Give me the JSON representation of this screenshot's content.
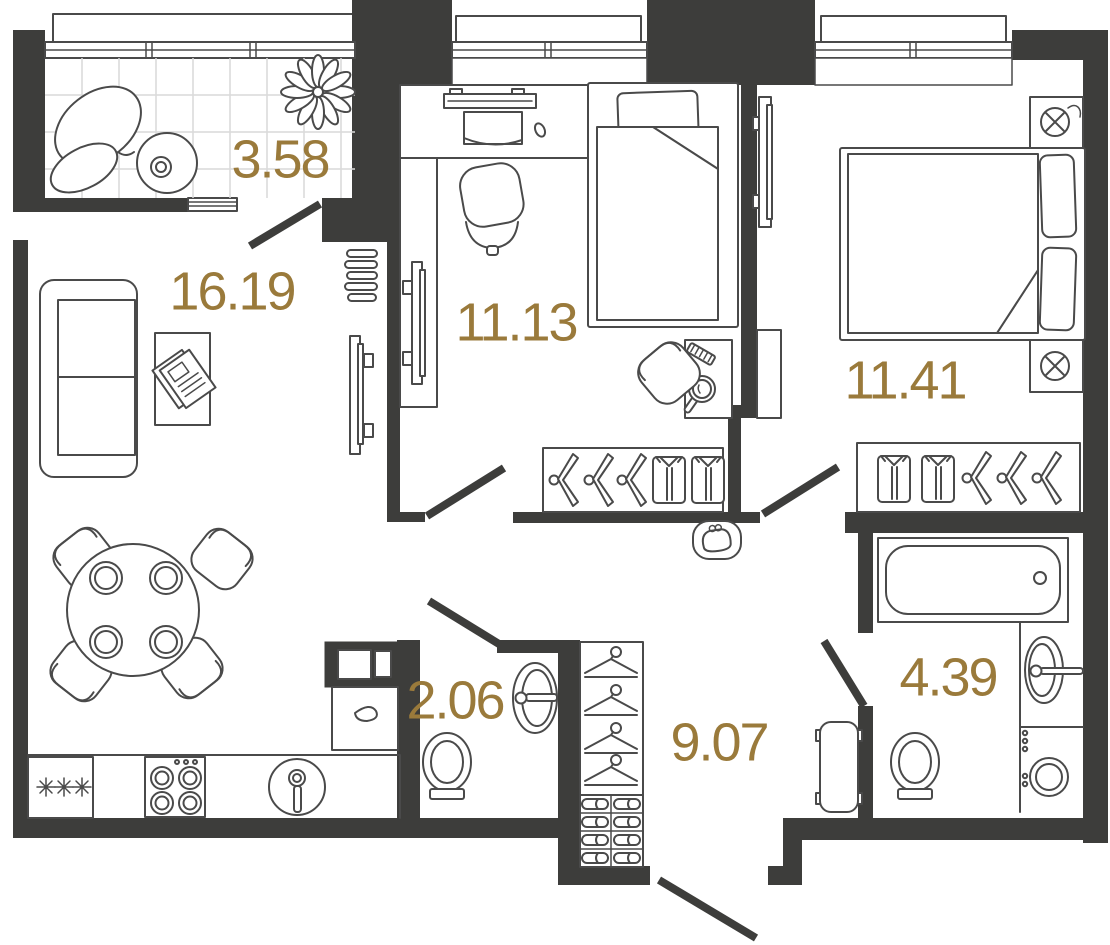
{
  "plan": {
    "type": "apartment-floor-plan",
    "rooms": [
      {
        "name": "balcony",
        "area": "3.58"
      },
      {
        "name": "living-kitchen",
        "area": "16.19"
      },
      {
        "name": "bedroom-1",
        "area": "11.13"
      },
      {
        "name": "bedroom-2",
        "area": "11.41"
      },
      {
        "name": "wc",
        "area": "2.06"
      },
      {
        "name": "hallway",
        "area": "9.07"
      },
      {
        "name": "bathroom",
        "area": "4.39"
      }
    ],
    "colors": {
      "wall": "#3d3d3b",
      "furniture_line": "#4a4a4a",
      "area_label": "#9a7a3b",
      "tile_line": "#d9d9d9",
      "background": "#ffffff"
    },
    "icons": [
      "window",
      "window-sill",
      "door-swing",
      "sofa",
      "coffee-table",
      "newspaper",
      "tv",
      "slat-shelf",
      "dining-table",
      "dining-chair",
      "plate",
      "fridge-snowflakes",
      "hob",
      "kitchen-sink",
      "oven-column",
      "kitchen-cabinet",
      "lounge-chair",
      "side-table",
      "plant",
      "desk",
      "laptop",
      "mouse",
      "office-chair",
      "single-bed",
      "double-bed",
      "pillow",
      "blanket",
      "hanger",
      "shirt",
      "coat-hanger",
      "shoe-rack",
      "vanity-table",
      "hand-mirror",
      "comb",
      "chair",
      "nightstand",
      "bedside-lamp",
      "dresser",
      "pouf",
      "purse",
      "radiator",
      "toilet",
      "washbasin",
      "bathtub",
      "washing-machine",
      "entrance-door"
    ]
  }
}
